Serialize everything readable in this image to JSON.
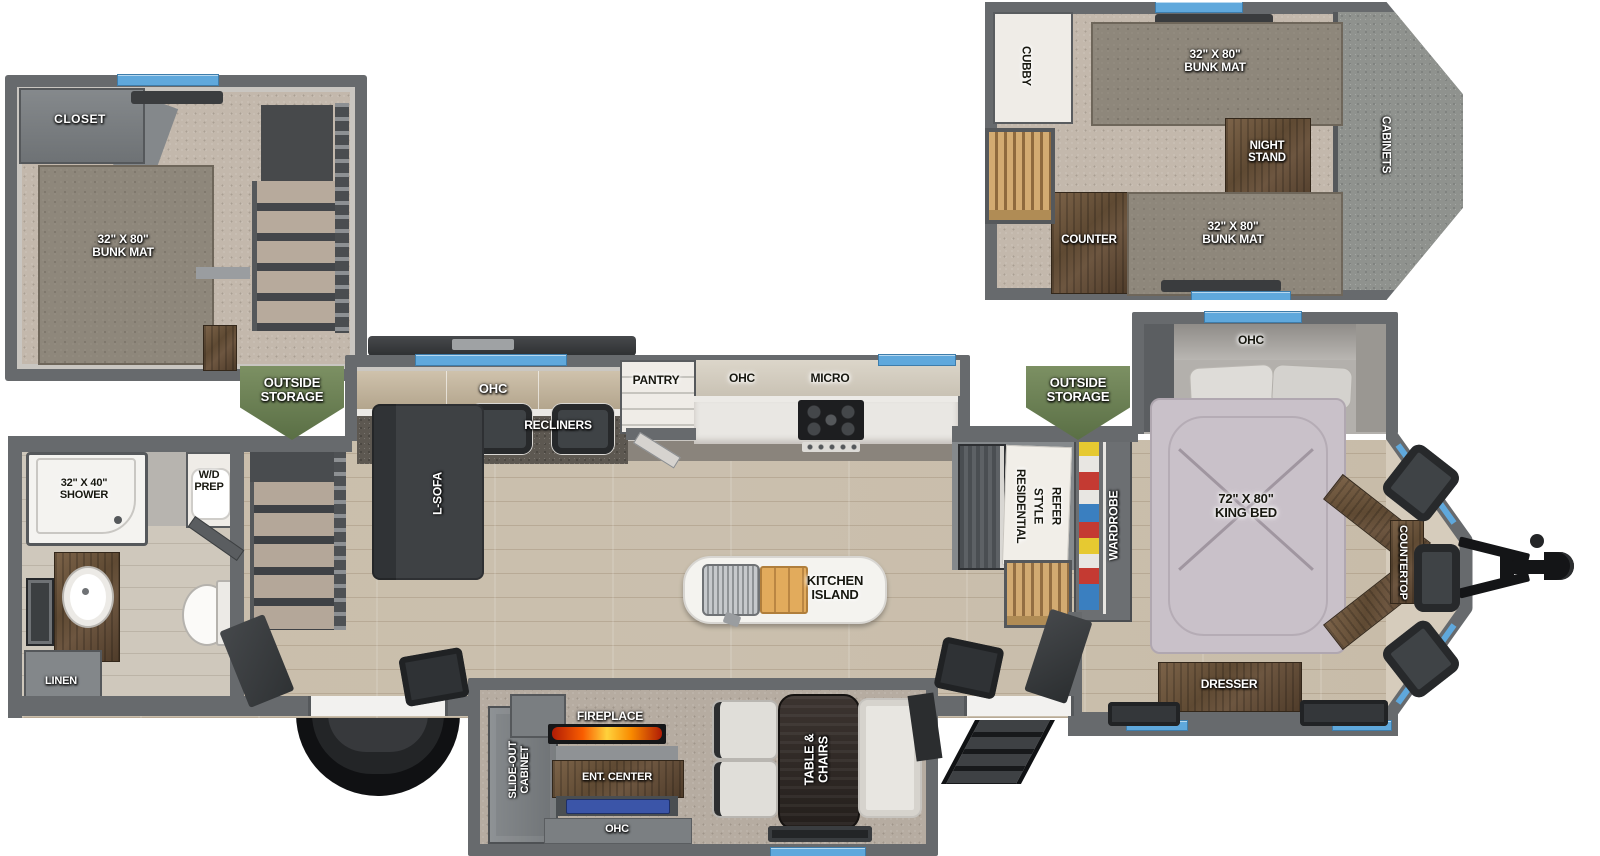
{
  "title": "destination-trailer-floorplan",
  "colors": {
    "wall_gray": "#676a6d",
    "window_blue": "#5fa8dc",
    "storage_green": "#6d8156",
    "flame_orange": "#f95d00",
    "tv_blue": "#3b55a8",
    "furniture_wood": "#6a543f",
    "floor_wood": "#d1c7b6",
    "carpet_tan": "#c3b8ac"
  },
  "labels": {
    "loft_left": {
      "closet": "CLOSET",
      "bunk_mat": "32\" X 80\"\nBUNK MAT"
    },
    "loft_right": {
      "cubby": "CUBBY",
      "bunk_top": "32\" X 80\"\nBUNK MAT",
      "night_stand": "NIGHT\nSTAND",
      "cabinets": "CABINETS",
      "counter": "COUNTER",
      "bunk_bottom": "32\" X 80\"\nBUNK MAT"
    },
    "storage_left": "OUTSIDE\nSTORAGE",
    "storage_right": "OUTSIDE\nSTORAGE",
    "living": {
      "ohc": "OHC",
      "recliners": "RECLINERS",
      "l_sofa": "L-SOFA"
    },
    "kitchen": {
      "pantry": "PANTRY",
      "ohc": "OHC",
      "micro": "MICRO",
      "island": "KITCHEN\nISLAND",
      "refer": "RESIDENTIAL\nSTYLE\nREFER"
    },
    "bath": {
      "shower": "32\" X 40\"\nSHOWER",
      "wd_prep": "W/D\nPREP",
      "linen": "LINEN"
    },
    "bedroom": {
      "ohc": "OHC",
      "wardrobe": "WARDROBE",
      "king_bed": "72\" X 80\"\nKING BED",
      "dresser": "DRESSER",
      "countertop": "COUNTERTOP"
    },
    "rear_slide": {
      "cabinet": "SLIDE-OUT\nCABINET",
      "fireplace": "FIREPLACE",
      "ent_center": "ENT. CENTER",
      "ohc": "OHC",
      "table_chairs": "TABLE &\nCHAIRS"
    }
  }
}
